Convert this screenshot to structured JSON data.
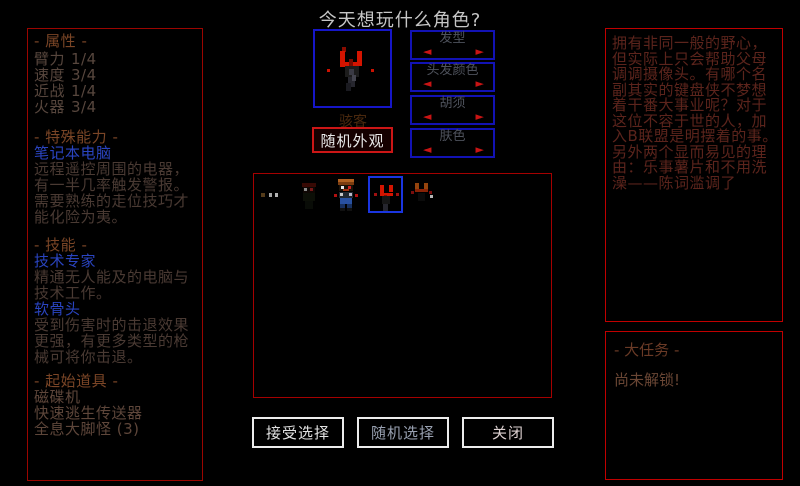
{
  "title": "今天想玩什么角色?",
  "left_panel": {
    "attributes_header": "- 属性 -",
    "stats": [
      {
        "label": "臂力",
        "value": "1/4"
      },
      {
        "label": "速度",
        "value": "3/4"
      },
      {
        "label": "近战",
        "value": "1/4"
      },
      {
        "label": "火器",
        "value": "3/4"
      }
    ],
    "special_ability_header": "- 特殊能力 -",
    "ability_name": "笔记本电脑",
    "ability_desc": "远程遥控周围的电器，有一半几率触发警报。需要熟练的走位技巧才能化险为夷。",
    "skills_header": "- 技能 -",
    "traits": [
      {
        "name": "技术专家",
        "desc": "精通无人能及的电脑与技术工作。"
      },
      {
        "name": "软骨头",
        "desc": "受到伤害时的击退效果更强，有更多类型的枪械可将你击退。"
      }
    ],
    "items_header": "- 起始道具 -",
    "items": [
      "磁碟机",
      "快速逃生传送器",
      "全息大脚怪 (3)"
    ]
  },
  "center": {
    "character_name": "骇客",
    "random_appearance_button": "随机外观",
    "appearance_options": [
      {
        "label": "发型"
      },
      {
        "label": "头发颜色"
      },
      {
        "label": "胡须"
      },
      {
        "label": "肤色"
      }
    ],
    "buttons": {
      "accept": "接受选择",
      "random": "随机选择",
      "close": "关闭"
    }
  },
  "right_panel": {
    "bio": "拥有非同一般的野心，但实际上只会帮助父母调调摄像头。有哪个名副其实的键盘侠不梦想着干番大事业呢？对于这位不容于世的人，加入B联盟是明摆着的事。另外两个显而易见的理由：乐事薯片和不用洗澡——陈词滥调了",
    "big_quest_header": "- 大任务 -",
    "big_quest_status": "尚未解锁!"
  },
  "icons": {
    "arrow_left": "◄",
    "arrow_right": "►"
  },
  "colors": {
    "background": "#000000",
    "panel_border_red": "#a50000",
    "bright_border_red": "#cc1616",
    "panel_border_blue": "#1616c8",
    "selection_blue": "#1a35e0",
    "ability_name_blue": "#2a44c0",
    "header_brown": "#7a4526",
    "bio_dark_red": "#5c241c",
    "button_border_white": "#ececec",
    "arrow_red": "#c81414"
  }
}
